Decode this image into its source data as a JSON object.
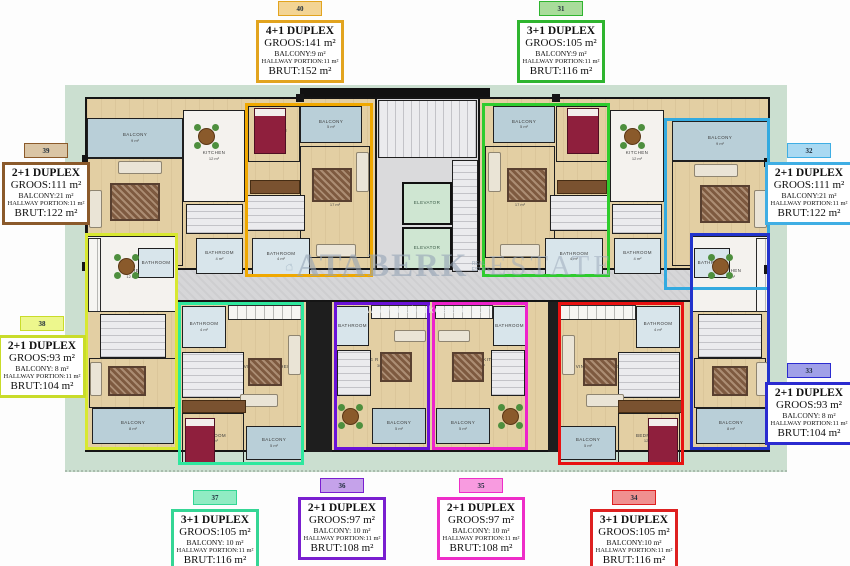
{
  "watermark": {
    "brand_left": "ATABERK",
    "brand_right": "ESTATE",
    "brand_small": "REAL ESTATE",
    "url": "www.ataberkestate.com"
  },
  "plan": {
    "labels": {
      "balcony": "BALCONY",
      "living": "LIVING R.",
      "kitchen": "KITCHEN",
      "bathroom": "BATHROOM",
      "bedroom": "BEDROOM",
      "living_kitchen": "LIVING R & KITCHEN",
      "elevator": "ELEVATOR"
    },
    "areas": {
      "a4": "4 m²",
      "a5": "5 m²",
      "a8": "8 m²",
      "a9": "9 m²",
      "a12": "12 m²",
      "a17": "17 m²",
      "a21": "21 m²",
      "a30": "30 m²",
      "a34": "34 m²"
    },
    "colors": {
      "plot": "#CBDFD0",
      "floor": "#E3CFA3",
      "balcony": "#B9CFD8",
      "kitchen": "#F4F2EE",
      "bathroom": "#D8E5EB",
      "wall": "#1A1A1A",
      "elevator": "#CFE6D2",
      "corridor": "#D6D6D8"
    }
  },
  "units": {
    "u40": {
      "number": "40",
      "type": "4+1 DUPLEX",
      "groos": "GROOS:141 m²",
      "balcony": "BALCONY:9 m²",
      "hallway": "HALLWAY PORTION:11 m²",
      "brut": "BRUT:152 m²",
      "border": "#E2A41F",
      "chip_bg": "#F3D494",
      "outline": "#F0A800"
    },
    "u31": {
      "number": "31",
      "type": "3+1 DUPLEX",
      "groos": "GROOS:105 m²",
      "balcony": "BALCONY:9 m²",
      "hallway": "HALLWAY PORTION:11 m²",
      "brut": "BRUT:116 m²",
      "border": "#2FB52F",
      "chip_bg": "#A9DC9B",
      "outline": "#2ECC2E"
    },
    "u39": {
      "number": "39",
      "type": "2+1 DUPLEX",
      "groos": "GROOS:111 m²",
      "balcony": "BALCONY:21 m²",
      "hallway": "HALLWAY PORTION:11 m²",
      "brut": "BRUT:122 m²",
      "border": "#8B5A2B",
      "chip_bg": "#DAC5A5",
      "outline": "#8B5A2B"
    },
    "u32": {
      "number": "32",
      "type": "2+1 DUPLEX",
      "groos": "GROOS:111 m²",
      "balcony": "BALCONY:21 m²",
      "hallway": "HALLWAY PORTION:11 m²",
      "brut": "BRUT:122 m²",
      "border": "#3FAEE4",
      "chip_bg": "#A9D9F2",
      "outline": "#33AAE0"
    },
    "u38": {
      "number": "38",
      "type": "2+1 DUPLEX",
      "groos": "GROOS:93 m²",
      "balcony": "BALCONY: 8 m²",
      "hallway": "HALLWAY PORTION:11 m²",
      "brut": "BRUT:104 m²",
      "border": "#C9DC2A",
      "chip_bg": "#EDF78D",
      "outline": "#D8E830"
    },
    "u33": {
      "number": "33",
      "type": "2+1 DUPLEX",
      "groos": "GROOS:93 m²",
      "balcony": "BALCONY: 8 m²",
      "hallway": "HALLWAY PORTION:11 m²",
      "brut": "BRUT:104 m²",
      "border": "#2B2BD0",
      "chip_bg": "#A0A0E8",
      "outline": "#2233CC"
    },
    "u37": {
      "number": "37",
      "type": "3+1 DUPLEX",
      "groos": "GROOS:105 m²",
      "balcony": "BALCONY: 10 m²",
      "hallway": "HALLWAY PORTION:11 m²",
      "brut": "BRUT:116 m²",
      "border": "#35D695",
      "chip_bg": "#90ECC3",
      "outline": "#2EE89E"
    },
    "u36": {
      "number": "36",
      "type": "2+1 DUPLEX",
      "groos": "GROOS:97 m²",
      "balcony": "BALCONY: 10 m²",
      "hallway": "HALLWAY PORTION:11 m²",
      "brut": "BRUT:108 m²",
      "border": "#7A1FD0",
      "chip_bg": "#C5A2EA",
      "outline": "#6A11D8"
    },
    "u35": {
      "number": "35",
      "type": "2+1 DUPLEX",
      "groos": "GROOS:97 m²",
      "balcony": "BALCONY: 10 m²",
      "hallway": "HALLWAY PORTION:11 m²",
      "brut": "BRUT:108 m²",
      "border": "#EE2DC8",
      "chip_bg": "#F89BE0",
      "outline": "#EE22CC"
    },
    "u34": {
      "number": "34",
      "type": "3+1 DUPLEX",
      "groos": "GROOS:105 m²",
      "balcony": "BALCONY:10 m²",
      "hallway": "HALLWAY PORTION:11 m²",
      "brut": "BRUT:116 m²",
      "border": "#DE2121",
      "chip_bg": "#F09090",
      "outline": "#E81111"
    }
  }
}
